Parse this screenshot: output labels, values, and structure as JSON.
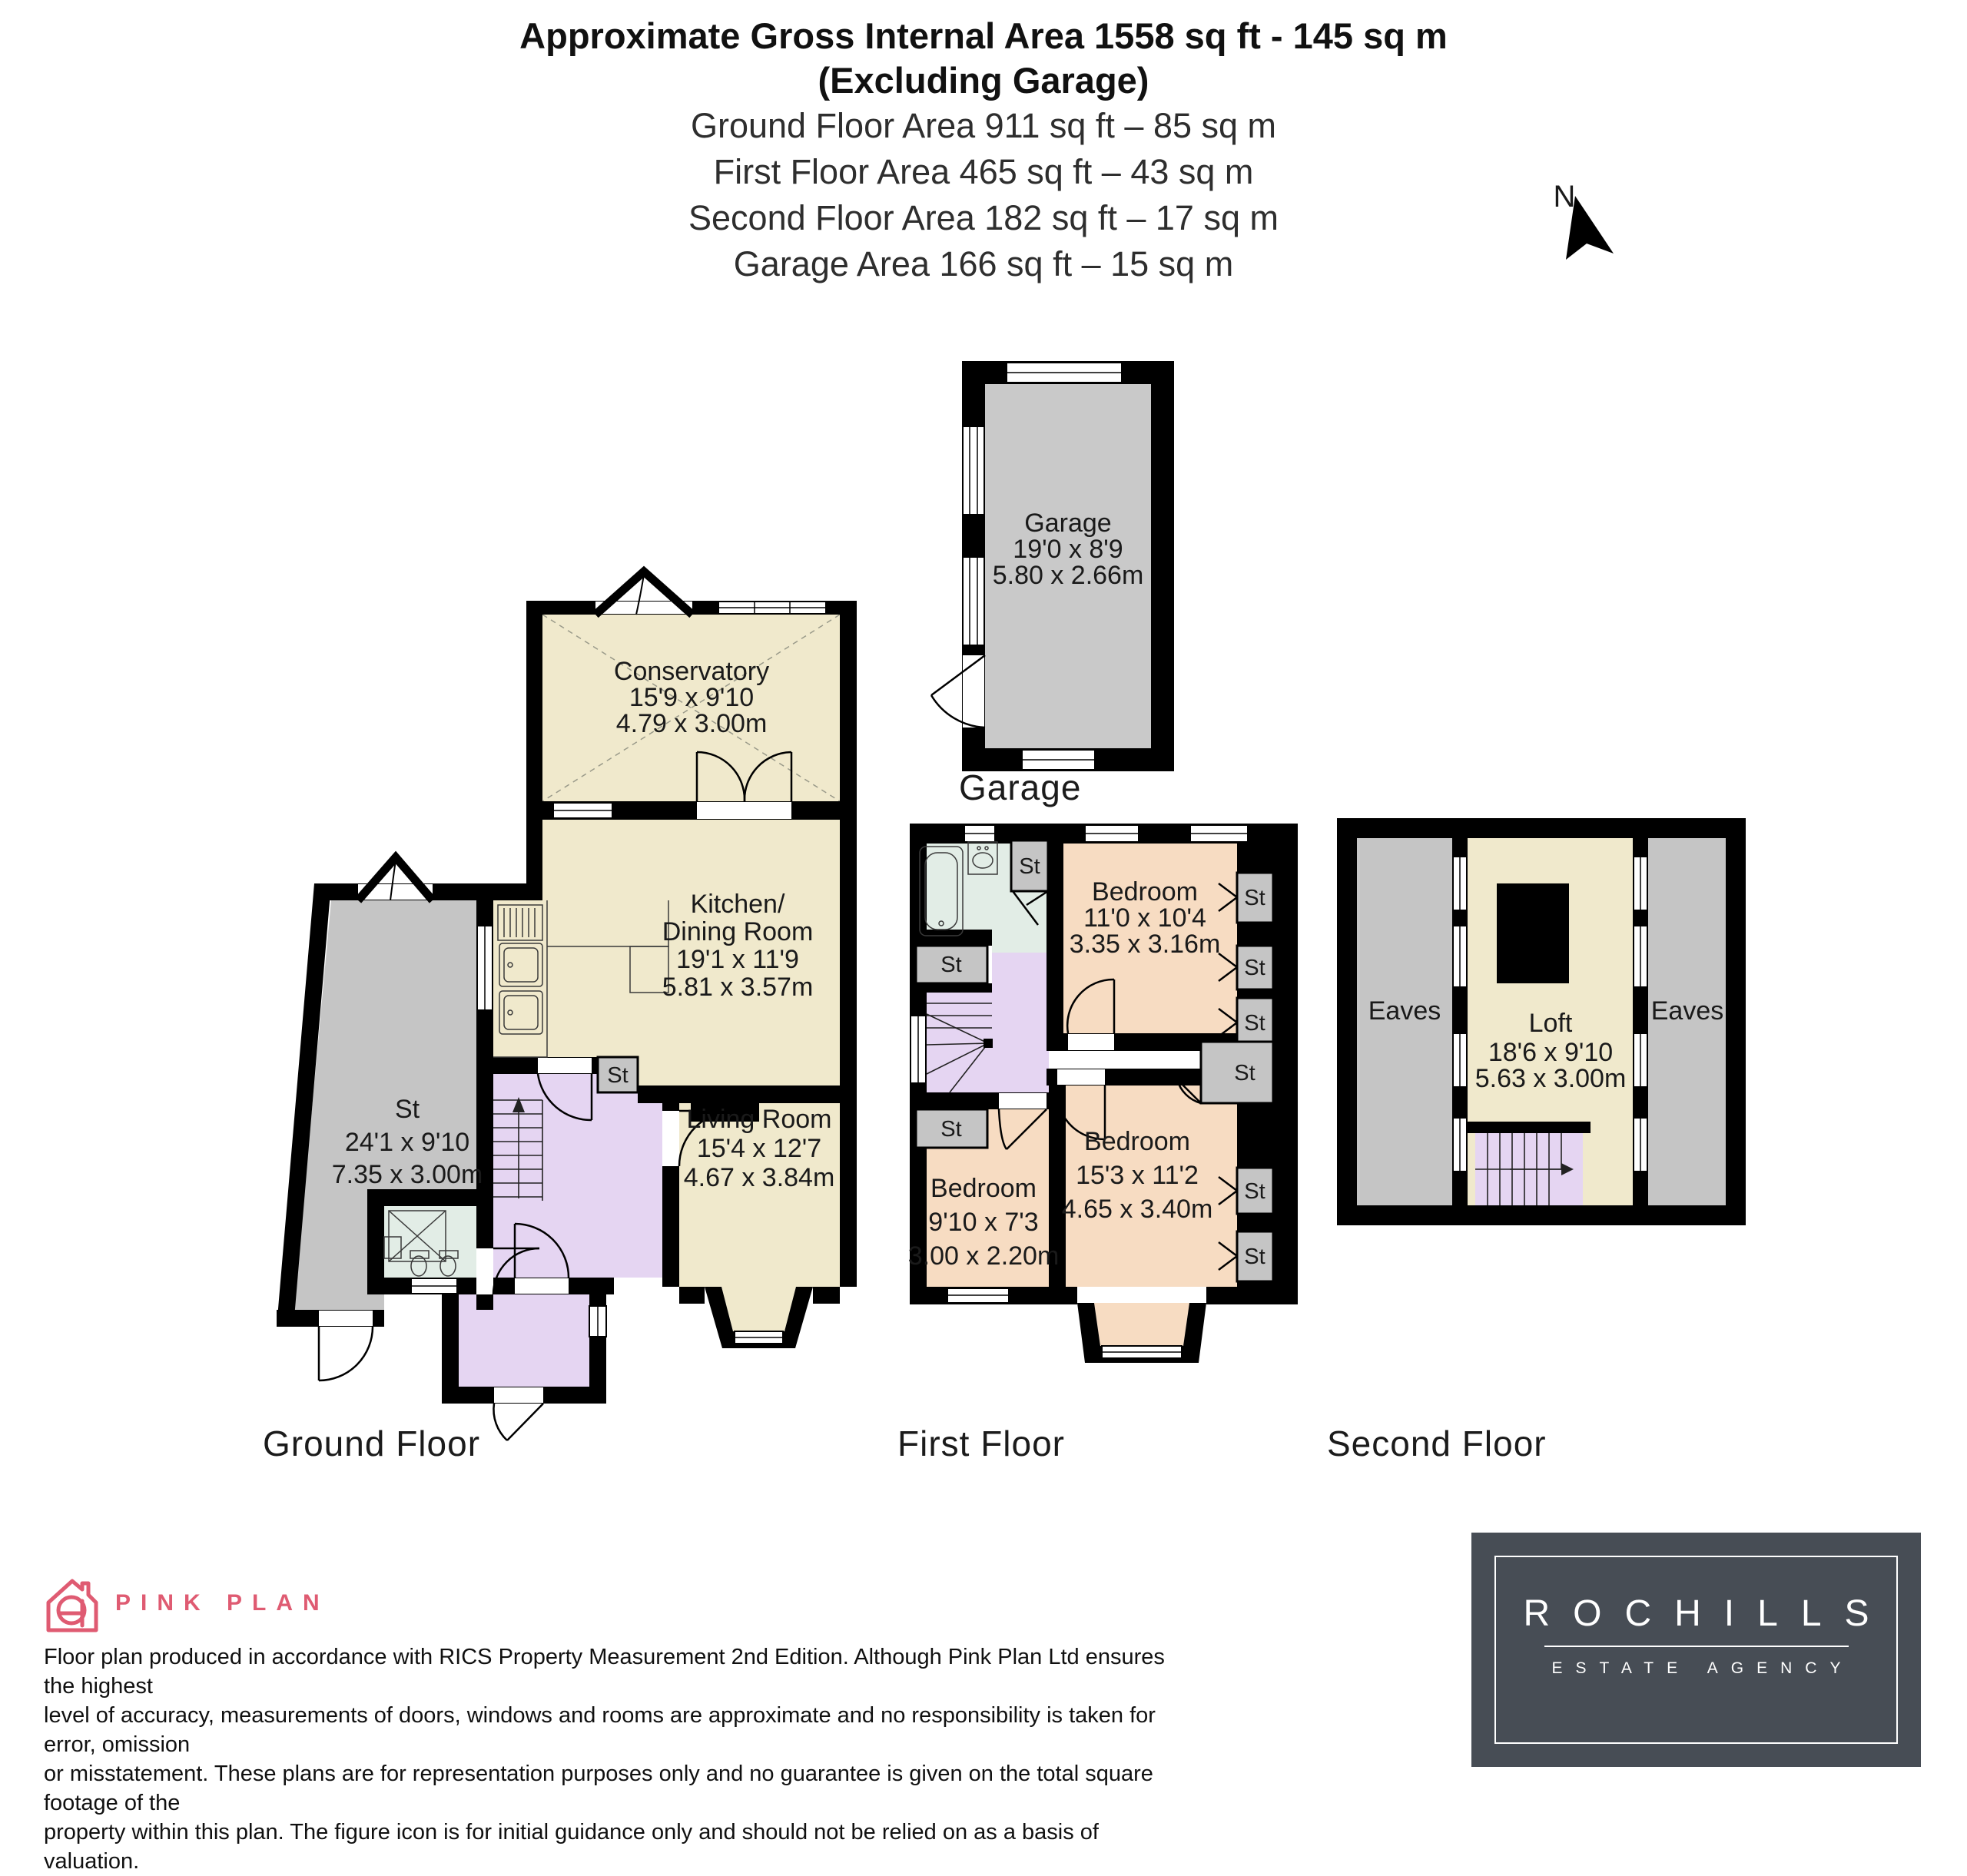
{
  "header": {
    "title_line1": "Approximate Gross Internal Area 1558 sq ft - 145 sq m",
    "title_line2": "(Excluding Garage)",
    "area_lines": [
      "Ground Floor Area 911 sq ft – 85 sq m",
      "First Floor Area 465 sq ft – 43 sq m",
      "Second Floor Area 182 sq ft – 17 sq m",
      "Garage Area 166 sq ft – 15 sq m"
    ]
  },
  "compass": {
    "north_label": "N"
  },
  "labels": {
    "st": "St",
    "eaves": "Eaves"
  },
  "garage_plan": {
    "caption": "Garage",
    "room": {
      "name": "Garage",
      "imperial": "19'0 x 8'9",
      "metric": "5.80 x 2.66m"
    }
  },
  "ground_floor": {
    "caption": "Ground Floor",
    "conservatory": {
      "name": "Conservatory",
      "imperial": "15'9 x 9'10",
      "metric": "4.79 x 3.00m"
    },
    "kitchen": {
      "name_line1": "Kitchen/",
      "name_line2": "Dining Room",
      "imperial": "19'1 x 11'9",
      "metric": "5.81 x 3.57m"
    },
    "storage": {
      "name": "St",
      "imperial": "24'1 x 9'10",
      "metric": "7.35 x 3.00m"
    },
    "living_room": {
      "name": "Living Room",
      "imperial": "15'4 x 12'7",
      "metric": "4.67 x 3.84m"
    }
  },
  "first_floor": {
    "caption": "First Floor",
    "bedroom_rear": {
      "name": "Bedroom",
      "imperial": "11'0 x 10'4",
      "metric": "3.35 x 3.16m"
    },
    "bedroom_front": {
      "name": "Bedroom",
      "imperial": "15'3 x 11'2",
      "metric": "4.65 x 3.40m"
    },
    "bedroom_small": {
      "name": "Bedroom",
      "imperial": "9'10 x 7'3",
      "metric": "3.00 x 2.20m"
    }
  },
  "second_floor": {
    "caption": "Second Floor",
    "loft": {
      "name": "Loft",
      "imperial": "18'6 x 9'10",
      "metric": "5.63 x 3.00m"
    }
  },
  "footer": {
    "brand_name": "PINK PLAN",
    "disclaimer_lines": [
      "Floor plan produced in accordance with RICS Property Measurement 2nd Edition. Although Pink Plan Ltd ensures the highest",
      "level of accuracy, measurements of doors, windows and rooms are approximate and no responsibility is taken for error, omission",
      "or misstatement. These plans are for representation purposes only and no guarantee is given on the total square footage of the",
      "property within this plan. The figure icon is for initial guidance only and should not be relied on as a basis of valuation."
    ],
    "agency_name": "ROCHILLS",
    "agency_tagline": "ESTATE AGENCY"
  },
  "colors": {
    "wall": "#000000",
    "room_cream": "#F0E9CC",
    "room_peach": "#F7DCC2",
    "room_lavender": "#E5D5F2",
    "room_bath_green": "#E2EDE6",
    "room_grey": "#C5C5C5",
    "brand_pink": "#DF5B72",
    "agency_slate": "#474D55"
  }
}
